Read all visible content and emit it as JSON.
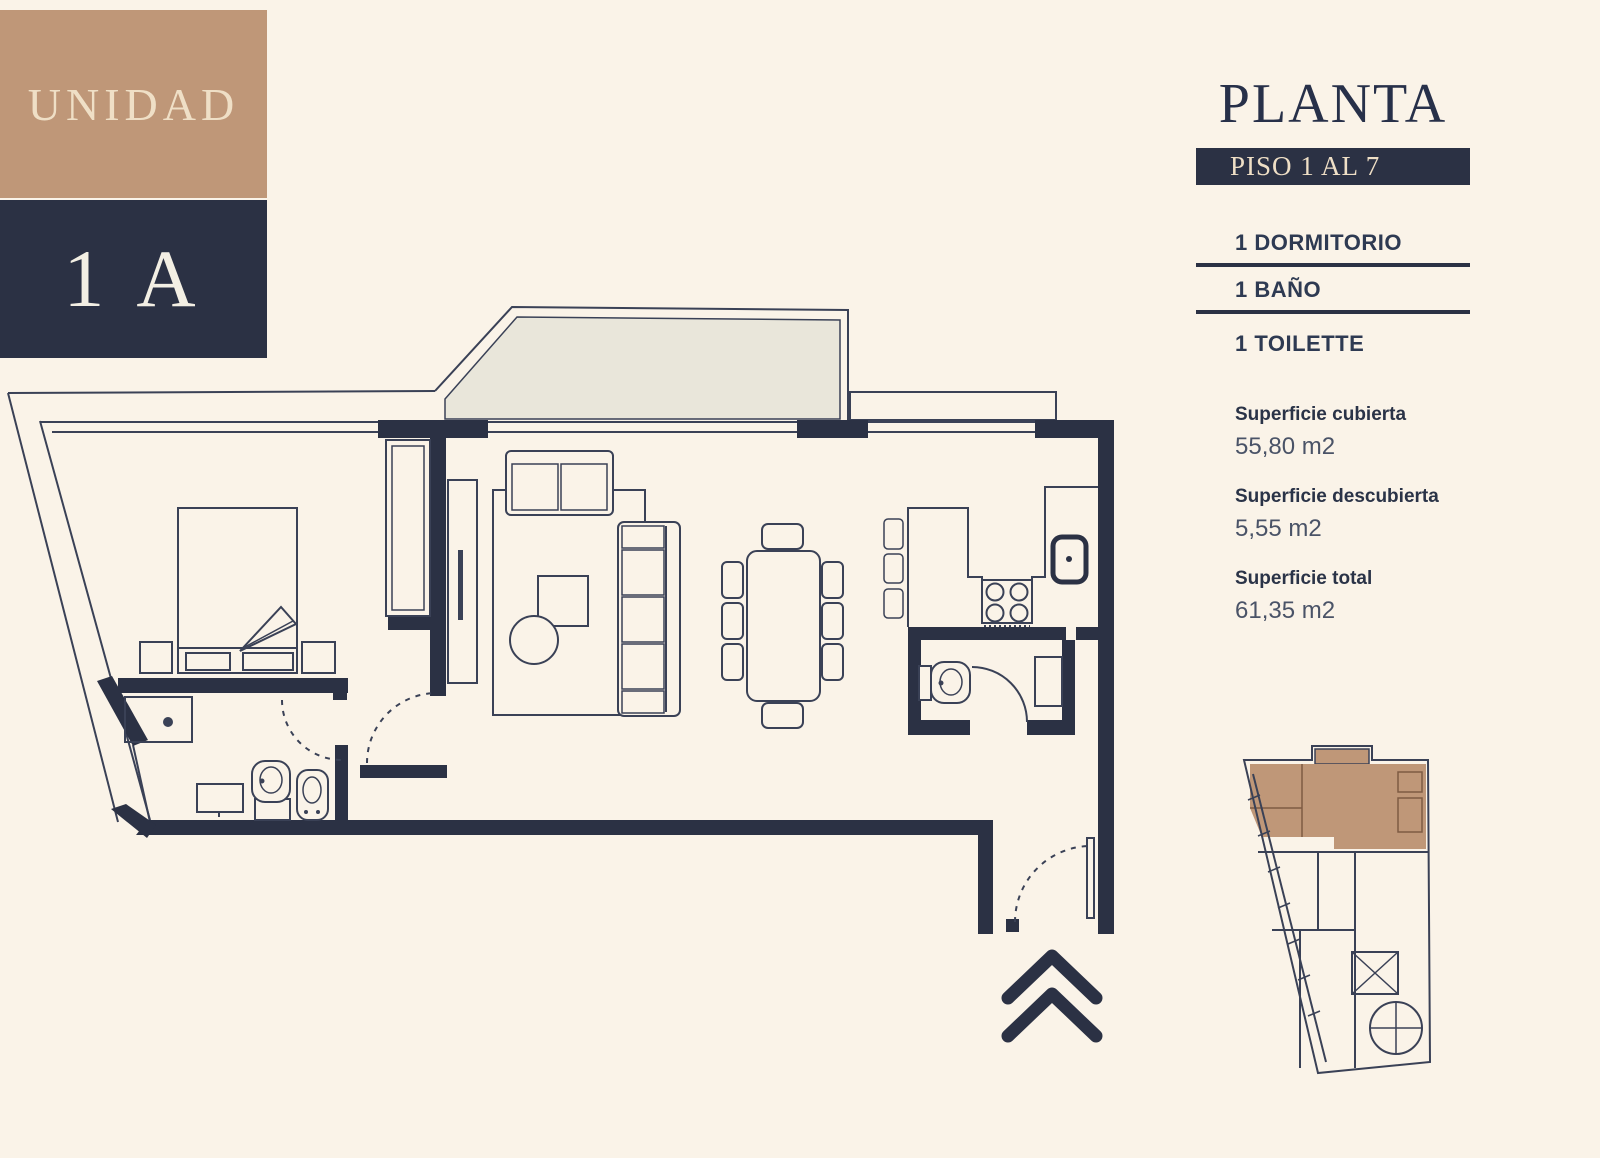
{
  "unit_badge": {
    "label": "UNIDAD",
    "code": "1 A"
  },
  "panel": {
    "title": "PLANTA",
    "floor_badge": "PISO 1 AL 7",
    "features": [
      "1 DORMITORIO",
      "1 BAÑO",
      "1 TOILETTE"
    ],
    "areas": [
      {
        "label": "Superficie cubierta",
        "value": "55,80 m2"
      },
      {
        "label": "Superficie descubierta",
        "value": "5,55 m2"
      },
      {
        "label": "Superficie total",
        "value": "61,35 m2"
      }
    ]
  },
  "floorplan": {
    "entry_marker_icon": "double-chevron-up-icon",
    "key_plan_highlighted_unit": "1 A"
  },
  "colors": {
    "background": "#FAF3E8",
    "wall_navy": "#2B3144",
    "text_navy": "#273049",
    "line": "#3A4156",
    "tan": "#BF9778",
    "badge_text_cream": "#EFDFC6",
    "balcony_fill": "#E9E6DA",
    "value_text": "#4A5367"
  }
}
